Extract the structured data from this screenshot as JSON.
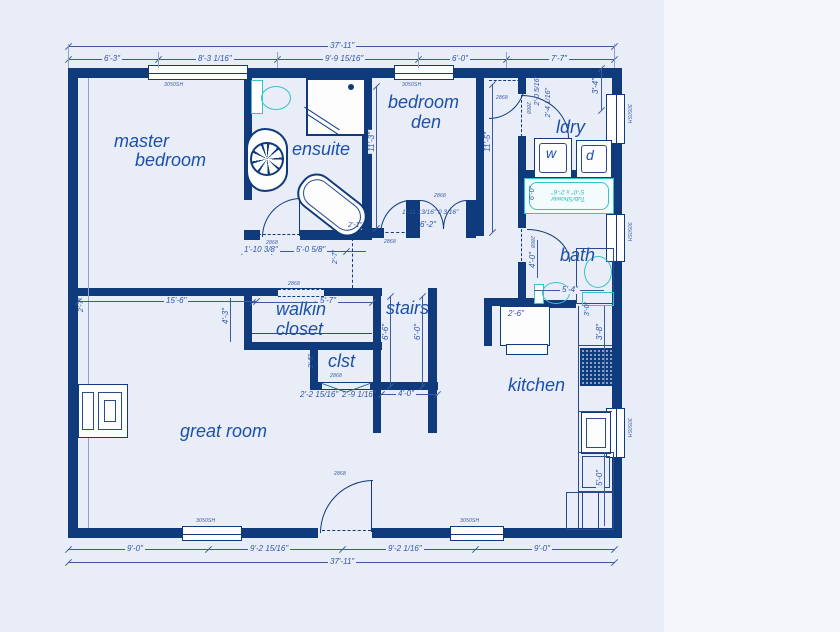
{
  "colors": {
    "wall": "#0f3a7c",
    "line": "#3b5aa0",
    "dim_text": "#2f55a8",
    "room_text": "#1d50a8",
    "fixture_cyan": "#35c4c8",
    "plan_bg": "#e8edf8",
    "page_bg": "#f5f6fb"
  },
  "rooms": {
    "master_line1": "master",
    "master_line2": "bedroom",
    "ensuite": "ensuite",
    "den_line1": "bedroom",
    "den_line2": "den",
    "ldry": "ldry",
    "bath": "bath",
    "walkin_line1": "walkin",
    "walkin_line2": "closet",
    "stairs": "stairs",
    "clst": "clst",
    "kitchen": "kitchen",
    "great_room": "great room"
  },
  "fixtures": {
    "washer": "w",
    "dryer": "d",
    "tub_line1": "Tub/Shower",
    "tub_line2": "5'-0\" x 2'-6\""
  },
  "dims": {
    "top_total": "37'-11\"",
    "top1": "6'-3\"",
    "top2": "8'-3 1/16\"",
    "top3": "9'-9 15/16\"",
    "top4": "6'-0\"",
    "top5": "7'-7\"",
    "bot1": "9'-0\"",
    "bot2": "9'-2 15/16\"",
    "bot3": "9'-2 1/16\"",
    "bot4": "9'-0\"",
    "bot_total": "37'-11\"",
    "den_height": "11'-3\"",
    "hall_height": "11'-5\"",
    "win_tr": "3'-4\"",
    "ldry1": "2'-0 5/16\"",
    "ldry2": "2'-4 1/16\"",
    "tub_side": "6'-0\"",
    "bath_w": "4'-0\"",
    "bath_l": "5'-4\"",
    "k1": "3'-0\"",
    "k2": "3'-8\"",
    "k3": "5'-0\"",
    "k4": "2'-6\"",
    "ens1": "1'-10 3/8\"",
    "ens2": "5'-0 5/8\"",
    "den_b1": "1'-11 13/16\" 0 3/16\"",
    "den_b2": "6'-2\"",
    "den_b3": "2'-1\"",
    "den_b4": "2'-7\"",
    "hall15": "15'-6\"",
    "w43": "4'-3\"",
    "w27": "2'-7\"",
    "walkin_w": "5'-7\"",
    "st1": "6'-6\"",
    "st2": "6'-0\"",
    "st3": "4'-0\"",
    "cl1": "2'-5\"",
    "cl2": "2'-2 15/16\"",
    "cl3": "2'-9 1/16\""
  },
  "tags": {
    "window": "3050SH",
    "door": "2868"
  }
}
